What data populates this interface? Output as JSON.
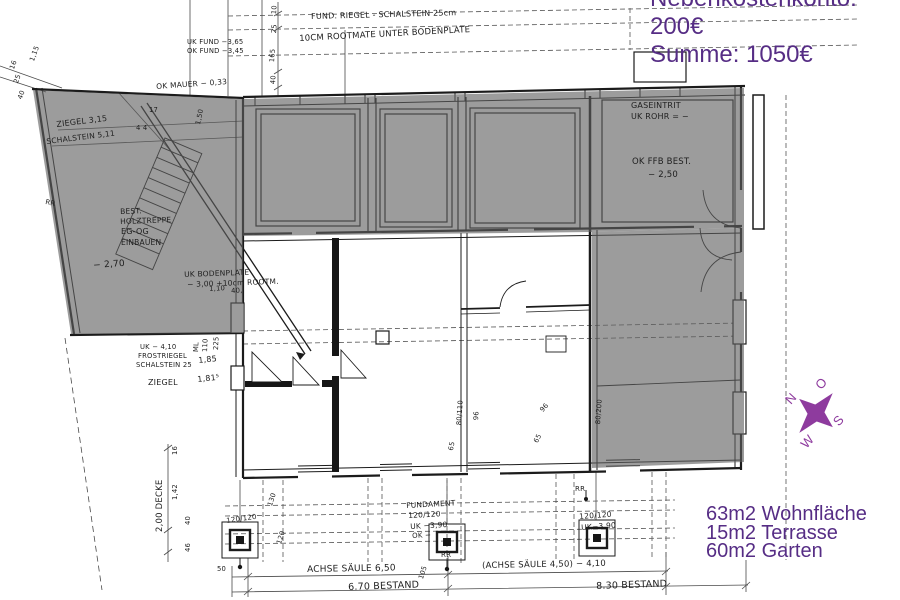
{
  "summary": {
    "line1": "Nebenkostenkonto: 200€",
    "line2": "Summe: 1050€"
  },
  "areas": {
    "wohnflaeche": "63m2 Wohnfläche",
    "terrasse": "15m2 Terrasse",
    "garten": "60m2 Garten"
  },
  "compass": {
    "north": "N",
    "east": "O",
    "south": "S",
    "west": "W"
  },
  "colors": {
    "annotation_purple": "#562d85",
    "compass_purple": "#8e3b9e",
    "highlight_gray": "#606060",
    "ink": "#1b1b1b"
  },
  "plan_notes": {
    "fund_riegel": "FUND. RIEGEL - SCHALSTEIN 25cm",
    "rootmate": "10CM ROOTMATE UNTER BODENPLATE",
    "uk_fund": "UK FUND −3,65",
    "ok_fund": "OK FUND −3,45",
    "ok_mauer": "OK MAUER − 0,33",
    "ziegel_315": "ZIEGEL 3,15",
    "schalstein_511": "SCHALSTEIN 5,11",
    "best1": "BEST.",
    "best2": "HOLZTREPPE",
    "best3": "EG-OG",
    "best4": "EINBAUEN",
    "minus_270": "− 2,70",
    "uk_boden1": "UK BODENPLATE",
    "uk_boden2": "− 3,00 +10cm ROOTM.",
    "uk_410": "UK − 4,10",
    "frostriegel": "FROSTRIEGEL",
    "schalstein_25": "SCHALSTEIN 25",
    "d_185": "1,85",
    "ziegel": "ZIEGEL",
    "d_1815": "1,81⁵",
    "gaseintrit": "GASEINTRIT",
    "uk_rohr": "UK ROHR = −",
    "ok_ffb": "OK FFB BEST.",
    "minus_250": "− 2,50",
    "fundament1": "FUNDAMENT",
    "fundament2": "120/120",
    "fundament3": "UK −3,90",
    "fundament4": "OK −",
    "footright1": "120/120",
    "footright2": "UK−3,90",
    "footleft": "120/120",
    "achse_650": "ACHSE SÄULE 6,50",
    "achse_450": "(ACHSE SÄULE 4,50) − 4,10",
    "bestand_670": "6.70 BESTAND",
    "bestand_830": "8.30 BESTAND",
    "rr_left": "RR",
    "rr_mid": "RR",
    "rr_right": "RR",
    "decke_200": "2,00 DECKE"
  },
  "dims": {
    "d10": "10",
    "d25": "25",
    "d165": "165",
    "d40": "40",
    "d115": "1,15",
    "d16": "16",
    "d25b": "25",
    "d40b": "40",
    "d150": "1,50",
    "d17": "17",
    "d44": "4 4",
    "d110": "1,10",
    "d40c": "40,",
    "dml": "ML",
    "d110b": "110",
    "d225": "225",
    "d16b": "16",
    "d142": "1,42",
    "d40d": "40",
    "d46": "46",
    "d130": "130",
    "d120": "120",
    "d105": "105",
    "d50": "50",
    "w80110": "80/110",
    "w96": "96",
    "w65": "65",
    "w96b": "96",
    "w65b": "65",
    "w80200": "80/200"
  }
}
